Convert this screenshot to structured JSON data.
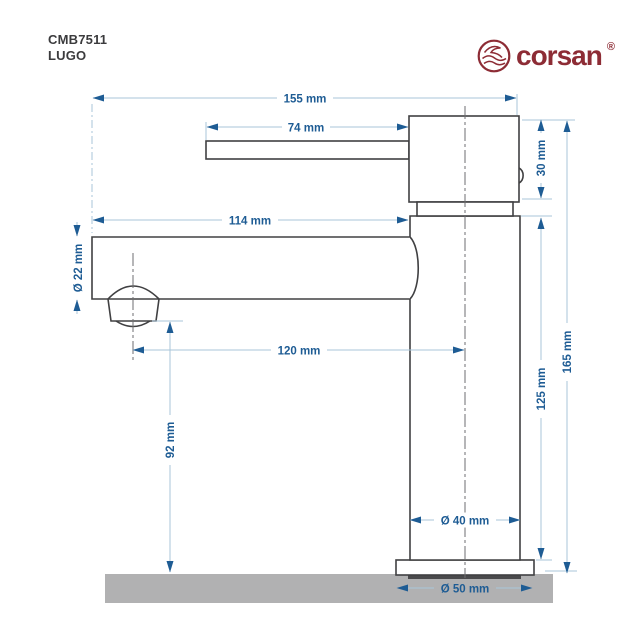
{
  "header": {
    "product_code": "CMB7511",
    "product_line": "LUGO"
  },
  "brand": {
    "name": "corsan",
    "registered_mark": "®",
    "color": "#8d2c35",
    "icon": "wave-circle-icon"
  },
  "diagram": {
    "type": "technical-drawing",
    "subject": "single-lever basin faucet, side view with dimension lines",
    "units": "mm",
    "dimensions": {
      "overall_width": "155 mm",
      "lever_length": "74 mm",
      "head_height": "30 mm",
      "spout_length": "114 mm",
      "spout_diameter": "Ø 22 mm",
      "spout_reach": "120 mm",
      "outlet_height": "92 mm",
      "body_height": "125 mm",
      "total_height": "165 mm",
      "body_diameter": "Ø 40 mm",
      "base_diameter": "Ø 50 mm"
    },
    "colors": {
      "dimension_accent": "#1e5c94",
      "dimension_line": "#a9c6da",
      "outline": "#404042",
      "centerline": "#6e6e70",
      "counter_surface": "#b1b1b2",
      "gasket": "#4a4a4c"
    }
  }
}
